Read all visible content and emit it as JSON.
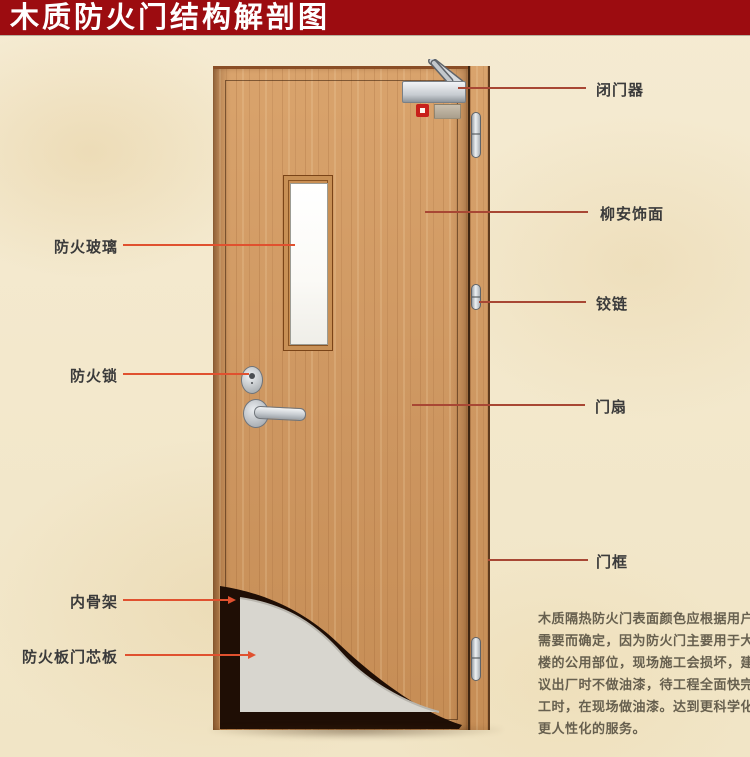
{
  "title": "木质防火门结构解剖图",
  "annotations": {
    "left": [
      {
        "id": "fire-glass",
        "text": "防火玻璃"
      },
      {
        "id": "fire-lock",
        "text": "防火锁"
      },
      {
        "id": "inner-skeleton",
        "text": "内骨架"
      },
      {
        "id": "fire-board-core",
        "text": "防火板门芯板"
      }
    ],
    "right": [
      {
        "id": "door-closer",
        "text": "闭门器"
      },
      {
        "id": "lauan-veneer",
        "text": "柳安饰面"
      },
      {
        "id": "hinge",
        "text": "铰链"
      },
      {
        "id": "door-leaf",
        "text": "门扇"
      },
      {
        "id": "door-frame",
        "text": "门框"
      }
    ]
  },
  "description": {
    "lines": [
      "木质隔热防火门表面颜色应根据用户",
      "需要而确定，因为防火门主要用于大",
      "楼的公用部位，现场施工会损坏，建",
      "议出厂时不做油漆，待工程全面快完",
      "工时，在现场做油漆。达到更科学化",
      "更人性化的服务。"
    ]
  },
  "colors": {
    "banner": "#9c0c10",
    "background": "#f3e8cc",
    "wood": "#d09a64",
    "skeleton_dark": "#1f0e05",
    "core_gray": "#d8d6cf",
    "leader_left": "#e0512f",
    "leader_right": "#a84734",
    "label_text": "#3b3b3b"
  }
}
